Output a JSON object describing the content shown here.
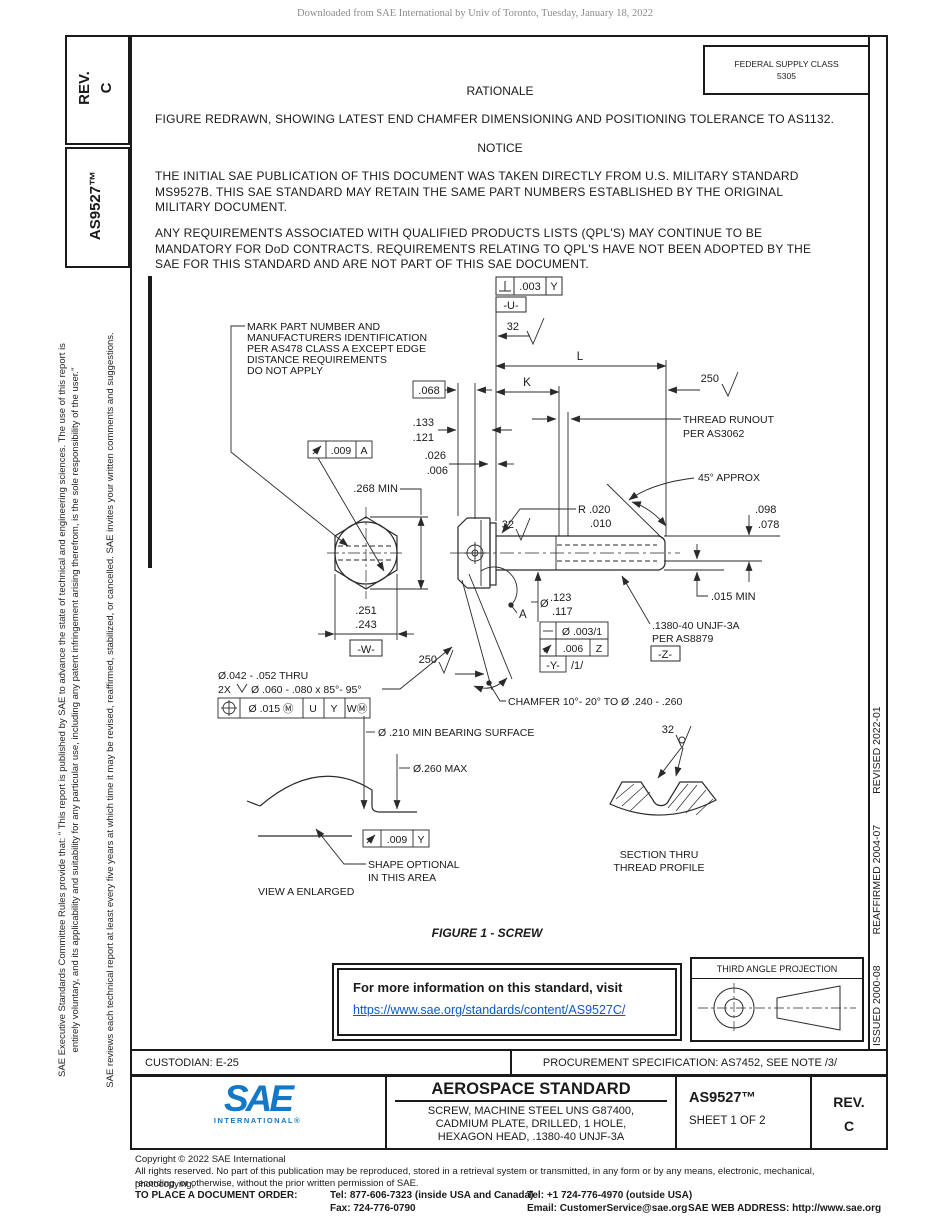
{
  "page": {
    "watermark": "Downloaded from SAE International by Univ of Toronto, Tuesday, January 18, 2022",
    "figure_caption": "FIGURE 1 - SCREW"
  },
  "header": {
    "fsc_line1": "FEDERAL SUPPLY CLASS",
    "fsc_line2": "5305",
    "rationale_title": "RATIONALE",
    "rationale_body": "FIGURE REDRAWN, SHOWING LATEST END CHAMFER DIMENSIONING AND POSITIONING TOLERANCE TO AS1132.",
    "notice_title": "NOTICE",
    "notice_para1": "THE INITIAL SAE PUBLICATION OF THIS DOCUMENT WAS TAKEN DIRECTLY FROM U.S. MILITARY STANDARD\nMS9527B. THIS SAE STANDARD MAY RETAIN THE SAME PART NUMBERS ESTABLISHED BY THE ORIGINAL\nMILITARY DOCUMENT.",
    "notice_para2": "ANY REQUIREMENTS ASSOCIATED WITH QUALIFIED PRODUCTS LISTS (QPL'S) MAY CONTINUE TO BE\nMANDATORY FOR DoD CONTRACTS. REQUIREMENTS RELATING TO QPL'S HAVE NOT BEEN ADOPTED BY THE\nSAE FOR THIS STANDARD AND ARE NOT PART OF THIS SAE DOCUMENT."
  },
  "left_sidebar": {
    "rev_line1": "REV.",
    "rev_line2": "C",
    "doc_number": "AS9527™",
    "legal_line1": "SAE Executive Standards Committee Rules provide that: \" This report is published by SAE to advance the state of technical and engineering sciences. The use of this report is",
    "legal_line2": "entirely voluntary, and its applicability and suitability for any particular use, including any patent infringement arising therefrom, is the sole responsibility of the user.\"",
    "legal_line3": "SAE reviews each technical report at least every five years at which time it may be revised, reaffirmed, stabilized, or cancelled. SAE invites your written comments and suggestions."
  },
  "right_sidebar": {
    "issued": "ISSUED 2000-08",
    "reaffirmed": "REAFFIRMED 2004-07",
    "revised": "REVISED 2022-01"
  },
  "drawing": {
    "mark_note_l1": "MARK PART NUMBER AND",
    "mark_note_l2": "MANUFACTURERS IDENTIFICATION",
    "mark_note_l3": "PER AS478 CLASS A EXCEPT EDGE",
    "mark_note_l4": "DISTANCE REQUIREMENTS",
    "mark_note_l5": "DO NOT APPLY",
    "dim_068": ".068",
    "dim_133": ".133",
    "dim_121": ".121",
    "dim_026": ".026",
    "dim_006": ".006",
    "dim_268": ".268 MIN",
    "fcf_head_tol": ".009",
    "fcf_head_datum": "A",
    "dim_251": ".251",
    "dim_243": ".243",
    "datum_w": "-W-",
    "hole_note_1": "Ø.042 - .052 THRU",
    "hole_note_2x": "2X",
    "hole_note_2": "Ø .060 - .080 x 85°- 95°",
    "pos_tol": "Ø .015 Ⓜ",
    "pos_d1": "U",
    "pos_d2": "Y",
    "pos_d3": "WⓂ",
    "perp_tol": ".003",
    "perp_datum": "Y",
    "datum_u": "-U-",
    "finish_top": "32",
    "finish_shank": "32",
    "finish_section": "32",
    "finish_250_top": "250",
    "finish_250_bot": "250",
    "dim_L": "L",
    "dim_K": "K",
    "runout_note_1": "THREAD RUNOUT",
    "runout_note_2": "PER AS3062",
    "approx_45": "45° APPROX",
    "dim_098": ".098",
    "dim_078": ".078",
    "dim_015": ".015 MIN",
    "dim_dia": "Ø",
    "dim_123": ".123",
    "dim_117": ".117",
    "straight_tol": "Ø .003/1",
    "fcf_runout_tol": ".006",
    "fcf_runout_datum": "Z",
    "datum_y": "-Y-",
    "per_inch": "/1/",
    "thread_note_1": ".1380-40 UNJF-3A",
    "thread_note_2": "PER AS8879",
    "datum_z": "-Z-",
    "chamfer_note": "CHAMFER 10°- 20° TO Ø .240 - .260",
    "detail_a": "A",
    "bearing_note": "Ø .210 MIN BEARING SURFACE",
    "dia_260": "Ø.260 MAX",
    "fcf_bearing_tol": ".009",
    "fcf_bearing_datum": "Y",
    "shape_note_1": "SHAPE  OPTIONAL",
    "shape_note_2": "IN THIS AREA",
    "view_a": "VIEW A ENLARGED",
    "section_1": "SECTION THRU",
    "section_2": "THREAD PROFILE"
  },
  "info_box": {
    "line1": "For more information on this standard, visit",
    "link": "https://www.sae.org/standards/content/AS9527C/"
  },
  "projection": {
    "label": "THIRD ANGLE PROJECTION"
  },
  "footer_bar": {
    "custodian": "CUSTODIAN: E-25",
    "procurement": "PROCUREMENT SPECIFICATION: AS7452, SEE NOTE /3/"
  },
  "title_block": {
    "logo_text": "SAE",
    "logo_sub": "INTERNATIONAL®",
    "doc_type": "AEROSPACE STANDARD",
    "title_line1": "SCREW, MACHINE STEEL UNS G87400,",
    "title_line2": "CADMIUM PLATE, DRILLED, 1 HOLE,",
    "title_line3": "HEXAGON HEAD, .1380-40 UNJF-3A",
    "doc_number": "AS9527™",
    "sheet": "SHEET 1 OF 2",
    "rev_label": "REV.",
    "rev_value": "C"
  },
  "footer": {
    "copyright1": "Copyright © 2022 SAE International",
    "copyright2": "All rights reserved. No part of this publication may be reproduced, stored in a retrieval system or transmitted, in any form or by any means, electronic, mechanical, photocopying,",
    "copyright3": "recording, or otherwise, without the prior written permission of SAE.",
    "order_label": "TO PLACE A DOCUMENT ORDER:",
    "tel1": "Tel: 877-606-7323 (inside USA and Canada)",
    "tel2": "Tel: +1 724-776-4970 (outside USA)",
    "fax": "Fax: 724-776-0790",
    "email": "Email: CustomerService@sae.org",
    "web": "SAE WEB ADDRESS: http://www.sae.org"
  }
}
